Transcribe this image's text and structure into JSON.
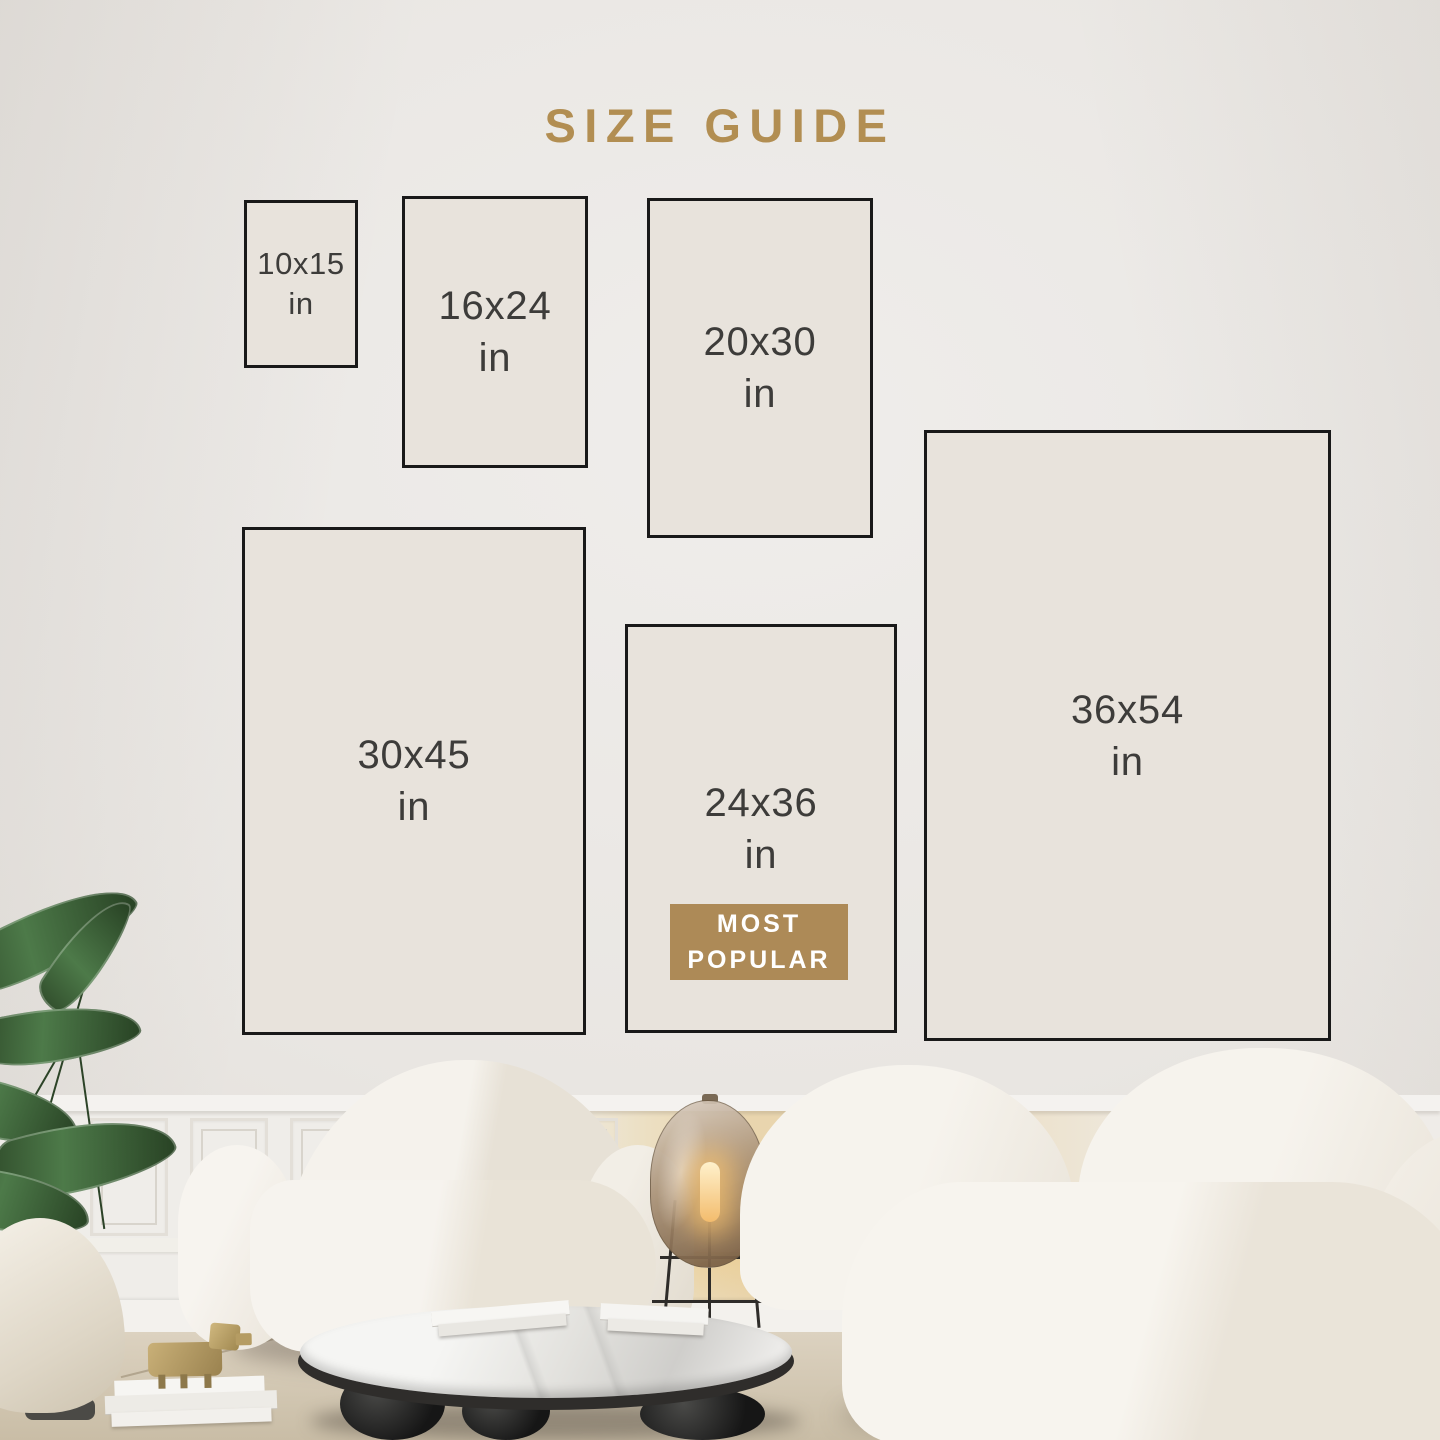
{
  "title": "SIZE GUIDE",
  "sizes": [
    {
      "label": "10x15",
      "unit": "in"
    },
    {
      "label": "16x24",
      "unit": "in"
    },
    {
      "label": "20x30",
      "unit": "in"
    },
    {
      "label": "30x45",
      "unit": "in"
    },
    {
      "label": "24x36",
      "unit": "in",
      "badge": "MOST POPULAR"
    },
    {
      "label": "36x54",
      "unit": "in"
    }
  ],
  "badge": {
    "line1": "MOST",
    "line2": "POPULAR"
  },
  "colors": {
    "accent": "#b28e52",
    "badge-bg": "#ad8a57",
    "label": "#3d3c3a",
    "line": "#191919",
    "rect-fill": "#e8e3dc"
  }
}
